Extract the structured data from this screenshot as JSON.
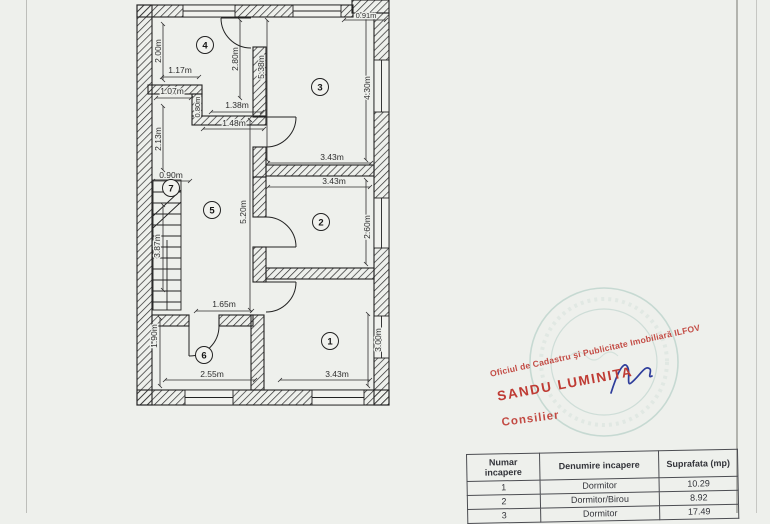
{
  "plan": {
    "room_numbers": [
      "1",
      "2",
      "3",
      "4",
      "5",
      "6",
      "7"
    ],
    "dims": [
      "2.00m",
      "1.17m",
      "1.07m",
      "0.80m",
      "1.38m",
      "1.48m",
      "2.13m",
      "2.80m",
      "5.38m",
      "0.91m",
      "4.30m",
      "3.43m",
      "3.43m",
      "0.90m",
      "3.87m",
      "5.20m",
      "2.60m",
      "1.65m",
      "1.90m",
      "2.55m",
      "3.43m",
      "3.00m"
    ]
  },
  "stamp": {
    "office_line": "Oficiul de Cadastru şi Publicitate Imobiliară ILFOV",
    "name": "SANDU LUMINITA",
    "title": "Consilier",
    "red": "#bf3b34",
    "teal": "#a6c6be",
    "signature_blue": "#2e3d9b"
  },
  "table": {
    "headers": [
      "Numar incapere",
      "Denumire incapere",
      "Suprafata (mp)"
    ],
    "rows": [
      [
        "1",
        "Dormitor",
        "10.29"
      ],
      [
        "2",
        "Dormitor/Birou",
        "8.92"
      ],
      [
        "3",
        "Dormitor",
        "17.49"
      ]
    ]
  }
}
